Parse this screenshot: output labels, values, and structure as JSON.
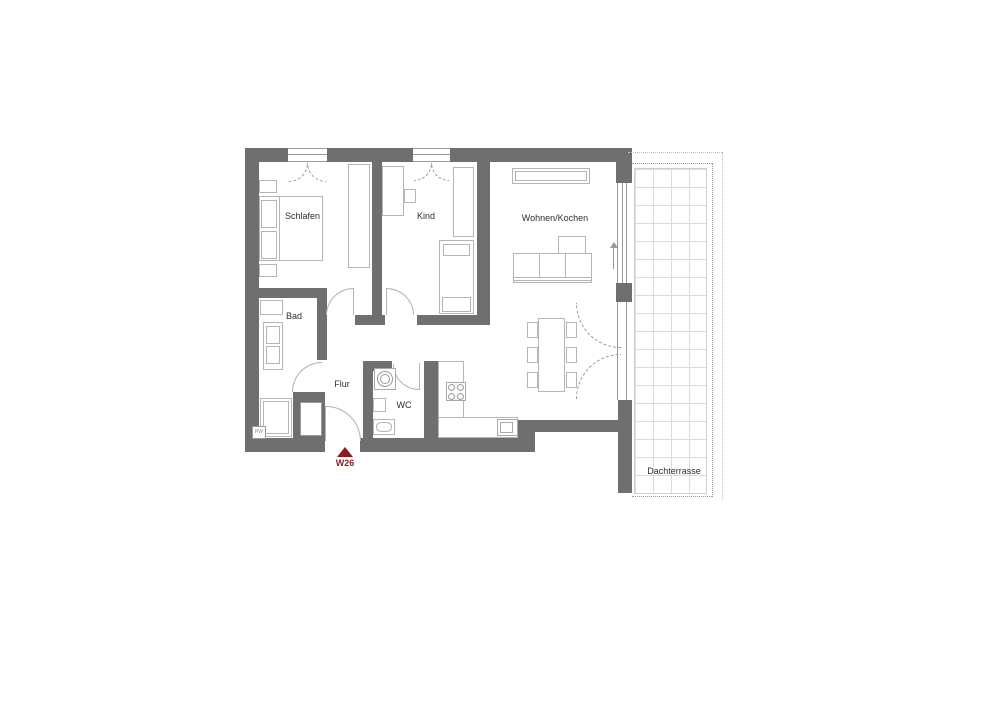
{
  "plan": {
    "unit": {
      "label": "W26",
      "marker_color": "#8e1c1c"
    },
    "wall_tag": "PW",
    "rooms": {
      "schlafen": "Schlafen",
      "kind": "Kind",
      "wohnen_kochen": "Wohnen/Kochen",
      "bad": "Bad",
      "flur": "Flur",
      "wc": "WC",
      "dachterrasse": "Dachterrasse"
    },
    "colors": {
      "wall": "#6f6f6f",
      "furniture_line": "#b5b5b5",
      "terrace_grid": "#dcdcdc",
      "text": "#2e2e2e"
    }
  }
}
